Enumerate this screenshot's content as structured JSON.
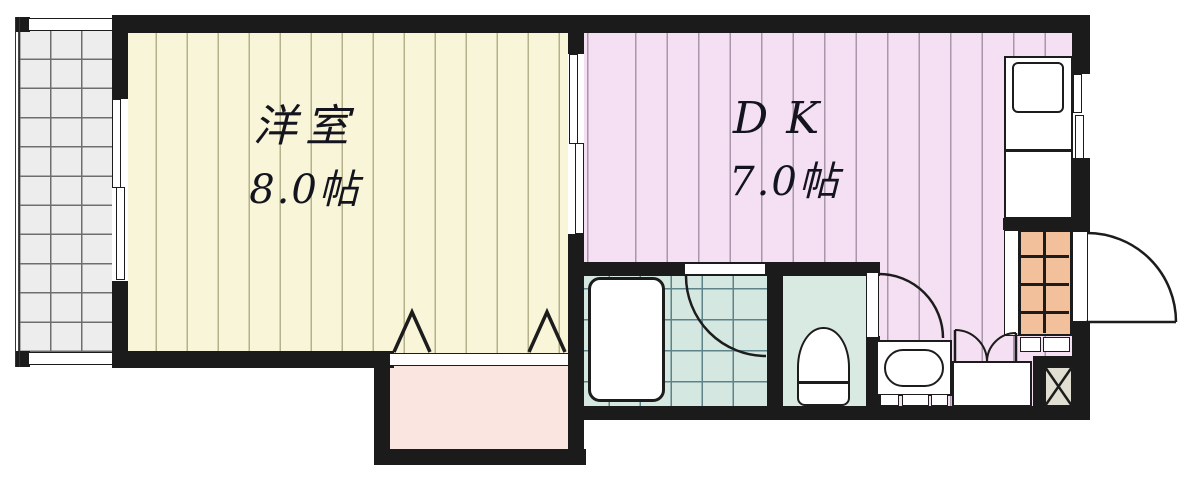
{
  "plan": {
    "rooms": [
      {
        "id": "western-room",
        "label": "洋室",
        "size": "8.0帖"
      },
      {
        "id": "dining-kitchen",
        "label": "DK",
        "size": "7.0帖"
      }
    ],
    "fixtures": [
      "balcony",
      "balcony-sliding-window",
      "room-partition-sliding-door",
      "closet",
      "closet-folding-door-marks",
      "bathtub",
      "bathroom-door",
      "toilet",
      "toilet-door",
      "washbasin",
      "laundry-closet-double-doors",
      "kitchen-counter",
      "kitchen-sink",
      "kitchen-window",
      "shoe-cabinet",
      "entrance-step",
      "entrance-door",
      "pipe-space"
    ],
    "colors": {
      "wall": "#1b1b1b",
      "room-yellow": "#f8f5d8",
      "room-yellow-line": "#b5b18a",
      "room-pink": "#f4e0f2",
      "room-pink-line": "#a896ac",
      "bath-teal": "#d4e7e1",
      "bath-teal-line": "#5d8287",
      "toilet-floor": "#d9eae3",
      "closet-pink": "#fbe5e1",
      "balcony-gray": "#ededed",
      "balcony-line": "#6e6e6e",
      "cabinet-orange": "#f2c09b",
      "pipe-space-beige": "#e0dfd1",
      "fixture-white": "#ffffff",
      "line-dark": "#1c1c1c",
      "text": "#14141e"
    }
  }
}
